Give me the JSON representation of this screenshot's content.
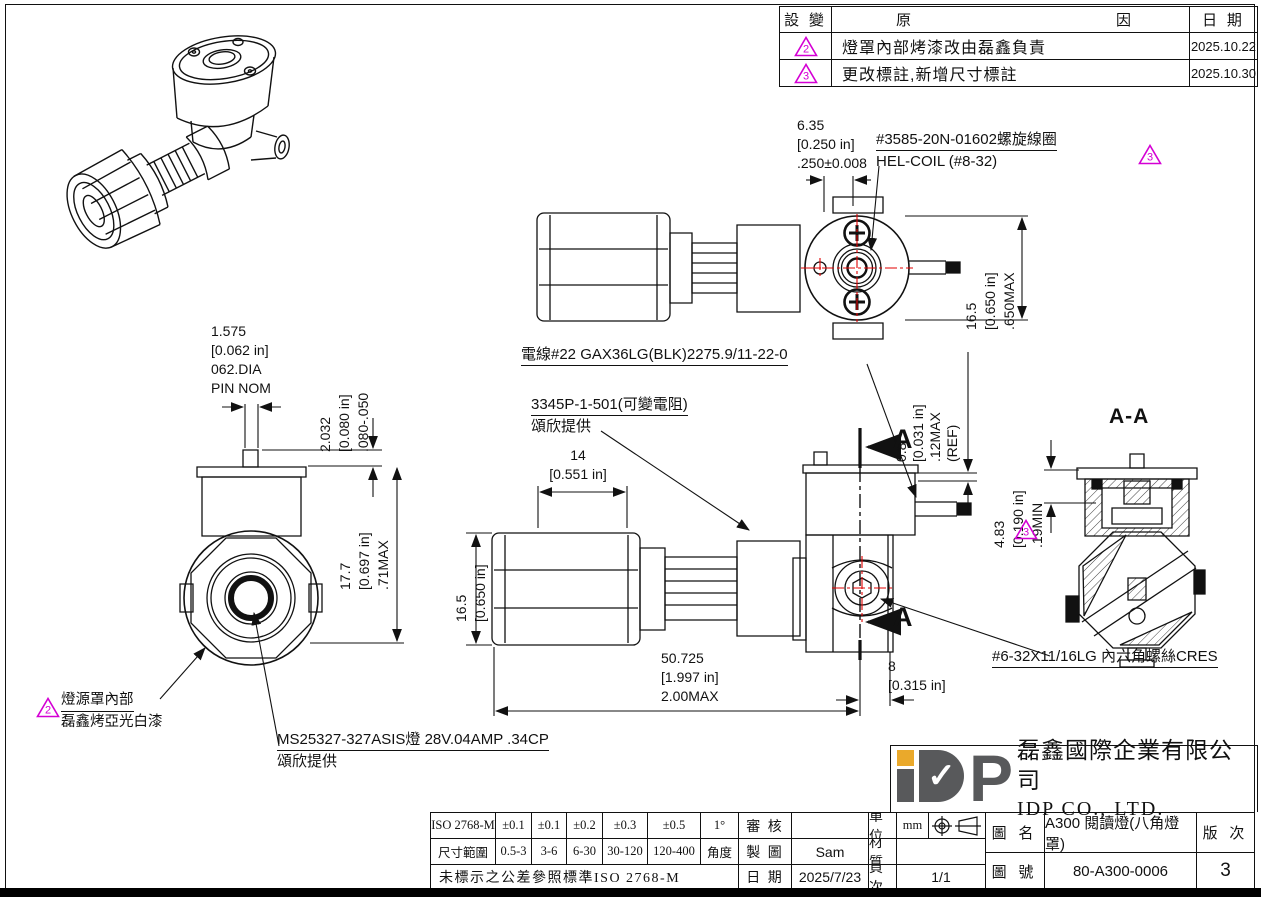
{
  "revision_table": {
    "col_change": "設 變",
    "col_reason_left": "原",
    "col_reason_right": "因",
    "col_date": "日 期",
    "rows": [
      {
        "mark": "2",
        "reason": "燈罩內部烤漆改由磊鑫負責",
        "date": "2025.10.22"
      },
      {
        "mark": "3",
        "reason": "更改標註,新增尺寸標註",
        "date": "2025.10.30"
      }
    ]
  },
  "annotations": {
    "helcoil_line1": "#3585-20N-01602螺旋線圈",
    "helcoil_line2": "HEL-COIL (#8-32)",
    "helcoil_mark": "3",
    "wire": "電線#22 GAX36LG(BLK)2275.9/11-22-0",
    "resistor_line1": "3345P-1-501(可變電阻)",
    "resistor_line2": "頌欣提供",
    "screw": "#6-32X11/16LG 內六角螺絲CRES",
    "shade_mark": "2",
    "shade_line1": "燈源罩內部",
    "shade_line2": "磊鑫烤亞光白漆",
    "bulb_line1": "MS25327-327ASIS燈 28V.04AMP .34CP",
    "bulb_line2": "頌欣提供",
    "section_letter": "A",
    "section_title": "A-A",
    "section_mark": "3"
  },
  "dims": {
    "d635": [
      "6.35",
      "[0.250 in]",
      ".250±0.008"
    ],
    "d650max": [
      "16.5",
      "[0.650 in]",
      ".650MAX"
    ],
    "pin": [
      "1.575",
      "[0.062 in]",
      "062.DIA",
      "PIN NOM"
    ],
    "d2032": [
      "2.032",
      "[0.080 in]",
      ".080-.050"
    ],
    "d177": [
      "17.7",
      "[0.697 in]",
      ".71MAX"
    ],
    "d08": [
      "0.8",
      "[0.031 in]",
      ".12MAX",
      "(REF)"
    ],
    "d483": [
      "4.83",
      "[0.190 in]",
      ".19MIN"
    ],
    "d14": [
      "14",
      "[0.551 in]"
    ],
    "d165": [
      "16.5",
      "[0.650 in]"
    ],
    "d50725": [
      "50.725",
      "[1.997 in]",
      "2.00MAX"
    ],
    "d8": [
      "8",
      "[0.315 in]"
    ]
  },
  "tolerance_table": {
    "row1": [
      "ISO 2768-M",
      "±0.1",
      "±0.1",
      "±0.2",
      "±0.3",
      "±0.5",
      "1°"
    ],
    "row2": [
      "尺寸範圍",
      "0.5-3",
      "3-6",
      "6-30",
      "30-120",
      "120-400",
      "角度"
    ],
    "note": "未標示之公差參照標準ISO 2768-M",
    "review_label": "審 核",
    "review_value": "",
    "draw_label": "製 圖",
    "draw_value": "Sam",
    "date_label": "日 期",
    "date_value": "2025/7/23",
    "unit_label": "單 位",
    "unit_value": "mm",
    "material_label": "材 質",
    "material_value": "",
    "page_label": "頁 次",
    "page_value": "1/1"
  },
  "title_block": {
    "company_cn": "磊鑫國際企業有限公司",
    "company_en": "IDP CO., LTD.",
    "logo_check": "✓",
    "logo_p": "P",
    "name_label": "圖 名",
    "name_value": "A300 閱讀燈(八角燈罩)",
    "rev_label": "版 次",
    "rev_value": "3",
    "no_label": "圖 號",
    "no_value": "80-A300-0006"
  },
  "colors": {
    "line": "#111111",
    "centerline_red": "#e00000",
    "revision_magenta": "#d400d4",
    "logo_gray": "#58595b",
    "logo_gold": "#eaa92b"
  }
}
